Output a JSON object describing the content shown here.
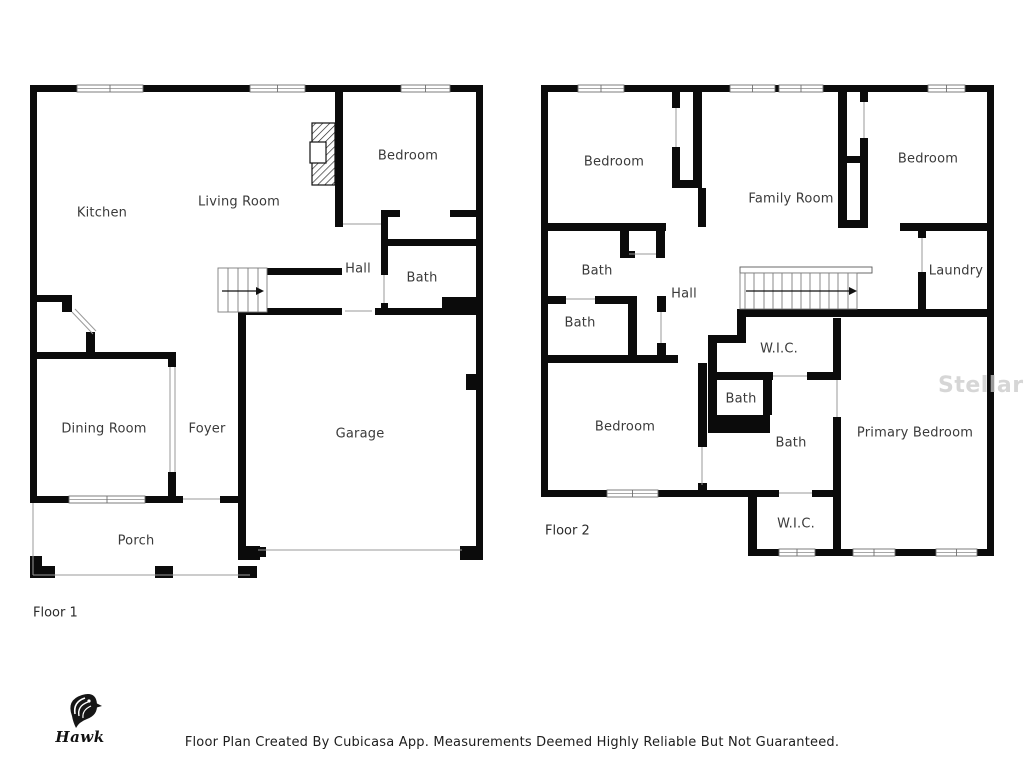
{
  "page": {
    "footer": "Floor Plan Created By Cubicasa App. Measurements Deemed Highly Reliable But Not Guaranteed.",
    "watermark": "Stellar MLS",
    "logo_text": "Hawk",
    "wall_color": "#0b0b0b"
  },
  "floors": [
    {
      "id": "floor-1",
      "label": "Floor 1",
      "label_pos": {
        "x": 33,
        "y": 613
      },
      "rooms": [
        {
          "name": "kitchen",
          "label": "Kitchen",
          "x": 102,
          "y": 213
        },
        {
          "name": "living-room",
          "label": "Living Room",
          "x": 239,
          "y": 202
        },
        {
          "name": "bedroom",
          "label": "Bedroom",
          "x": 408,
          "y": 156
        },
        {
          "name": "hall",
          "label": "Hall",
          "x": 358,
          "y": 269
        },
        {
          "name": "bath",
          "label": "Bath",
          "x": 422,
          "y": 278
        },
        {
          "name": "dining-room",
          "label": "Dining Room",
          "x": 104,
          "y": 429
        },
        {
          "name": "foyer",
          "label": "Foyer",
          "x": 207,
          "y": 429
        },
        {
          "name": "garage",
          "label": "Garage",
          "x": 360,
          "y": 434
        },
        {
          "name": "porch",
          "label": "Porch",
          "x": 136,
          "y": 541
        }
      ]
    },
    {
      "id": "floor-2",
      "label": "Floor 2",
      "label_pos": {
        "x": 545,
        "y": 531
      },
      "rooms": [
        {
          "name": "bedroom-top-left",
          "label": "Bedroom",
          "x": 614,
          "y": 162
        },
        {
          "name": "family-room",
          "label": "Family Room",
          "x": 791,
          "y": 199
        },
        {
          "name": "bedroom-top-right",
          "label": "Bedroom",
          "x": 928,
          "y": 159
        },
        {
          "name": "bath-upper",
          "label": "Bath",
          "x": 597,
          "y": 271
        },
        {
          "name": "hall",
          "label": "Hall",
          "x": 684,
          "y": 294
        },
        {
          "name": "bath-lower",
          "label": "Bath",
          "x": 580,
          "y": 323
        },
        {
          "name": "laundry",
          "label": "Laundry",
          "x": 956,
          "y": 271
        },
        {
          "name": "wic-top",
          "label": "W.I.C.",
          "x": 779,
          "y": 349
        },
        {
          "name": "bath-small",
          "label": "Bath",
          "x": 741,
          "y": 399
        },
        {
          "name": "bath-primary",
          "label": "Bath",
          "x": 791,
          "y": 443
        },
        {
          "name": "bedroom-bottom",
          "label": "Bedroom",
          "x": 625,
          "y": 427
        },
        {
          "name": "primary-bedroom",
          "label": "Primary Bedroom",
          "x": 915,
          "y": 433
        },
        {
          "name": "wic-bottom",
          "label": "W.I.C.",
          "x": 796,
          "y": 524
        }
      ]
    }
  ]
}
